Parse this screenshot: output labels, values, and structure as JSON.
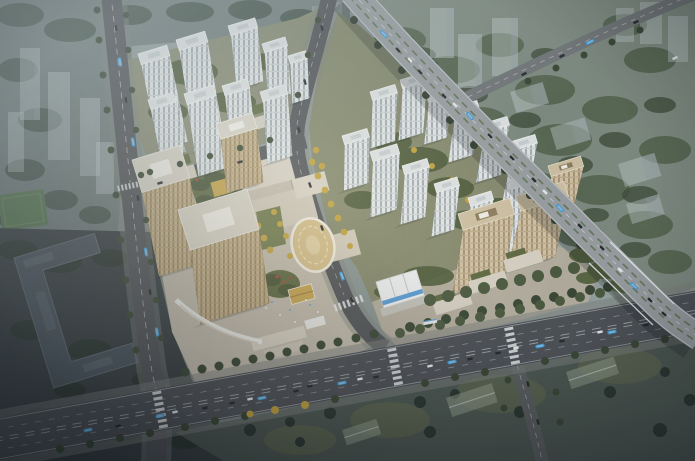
{
  "meta": {
    "type": "architectural-rendering",
    "view": "aerial-oblique bird's-eye",
    "description": "Dusk aerial rendering of a mixed-use development: a commercial complex with three beige office towers, a shopping-mall podium, rooftop gardens and an oval gold-roofed pavilion at center-left; white residential high-rise clusters to the north-west and north-east; three beige residential slab towers to the south-east with a white sales pavilion; all bounded by tree-lined arterial roads with buses and cars, a wide boulevard across the south, an elevated expressway with an overpass on the east, a dark office block at the south-west, and hazy city context with forest to the north-east."
  },
  "palette": {
    "forest_base": "#7e8b80",
    "forest_tree": "#55654f",
    "forest_tree_dark": "#43523f",
    "context_base": "#707d7b",
    "context_tree": "#47564d",
    "dark_ground": "#3a4245",
    "dark_tree": "#2e3a34",
    "dark_building": "#4d5861",
    "dark_building_edge": "#6d7880",
    "field_green": "#5a7b55",
    "road": "#54575b",
    "road_major": "#505459",
    "sidewalk": "#828784",
    "road_line": "#e6eaec",
    "viaduct": "#9aa0a3",
    "viaduct_median": "#5d7350",
    "plaza": "#c4beb0",
    "plaza_light": "#d6d1c3",
    "ground_p1": "#8a8e77",
    "ground_p2": "#868b6f",
    "ground_p4": "#b6b0a1",
    "lawn": "#6e7a4c",
    "lawn_dark": "#4f5d3d",
    "south_strip": "#4f5a54",
    "tree_street": "#3c4a38",
    "tree_street2": "#4d5b42",
    "tree_autumn": "#c2a340",
    "egg_shell": "#d5c08c",
    "egg_rim": "#efece0",
    "egg_inner": "#e0d0a4",
    "gold_deck": "#c9a84e",
    "gold_roof": "#c9a855",
    "red_accent": "#b0483a",
    "tent_white": "#eef1f2",
    "tent_blue": "#3f8fd4",
    "canopy_white": "#eef0ec",
    "bus_blue": "#3e9ad8",
    "car_dark": "#2a2e31",
    "car_white": "#e8ebec",
    "garden_roof": "#5f6b44"
  },
  "buildings": {
    "white_towers_nw": [
      [
        138,
        54,
        30,
        11,
        86
      ],
      [
        176,
        40,
        30,
        11,
        100
      ],
      [
        228,
        26,
        28,
        10,
        54
      ],
      [
        262,
        44,
        24,
        9,
        48
      ],
      [
        288,
        56,
        18,
        8,
        40
      ],
      [
        148,
        100,
        26,
        10,
        50
      ],
      [
        184,
        94,
        30,
        11,
        72
      ],
      [
        222,
        86,
        26,
        10,
        60
      ],
      [
        260,
        92,
        26,
        10,
        62
      ]
    ],
    "white_towers_ne": [
      [
        370,
        92,
        26,
        9,
        48
      ],
      [
        400,
        80,
        26,
        9,
        52
      ],
      [
        426,
        94,
        24,
        9,
        42
      ],
      [
        452,
        108,
        26,
        9,
        46
      ],
      [
        482,
        124,
        26,
        9,
        50
      ],
      [
        510,
        142,
        26,
        9,
        52
      ],
      [
        342,
        136,
        26,
        9,
        46
      ],
      [
        370,
        152,
        28,
        10,
        56
      ],
      [
        402,
        166,
        26,
        9,
        50
      ],
      [
        434,
        184,
        24,
        9,
        44
      ],
      [
        468,
        198,
        24,
        9,
        42
      ],
      [
        508,
        180,
        26,
        10,
        66
      ]
    ],
    "office_towers": [
      [
        216,
        124,
        38,
        16,
        54
      ],
      [
        132,
        160,
        50,
        34,
        84
      ],
      [
        178,
        210,
        72,
        42,
        74
      ]
    ],
    "slab_towers": [
      [
        548,
        166,
        34,
        11,
        48
      ],
      [
        516,
        196,
        50,
        16,
        60
      ],
      [
        458,
        214,
        54,
        17,
        64
      ]
    ]
  },
  "scene": {
    "districts": [
      {
        "name": "northwest-residential-cluster",
        "towers": 9
      },
      {
        "name": "northeast-residential-cluster",
        "towers": 12
      },
      {
        "name": "commercial-complex",
        "towers": 3,
        "features": [
          "mall podium",
          "oval pavilion",
          "roof gardens",
          "gold deck"
        ]
      },
      {
        "name": "southeast-residential-slabs",
        "towers": 3,
        "features": [
          "white sales pavilion",
          "retail strip"
        ]
      }
    ],
    "roads": [
      "south boulevard",
      "west avenue",
      "central street",
      "east-west street",
      "elevated expressway with overpass",
      "forest arterial",
      "south branch road"
    ],
    "vehicles": {
      "buses": 14,
      "cars": 46
    }
  }
}
